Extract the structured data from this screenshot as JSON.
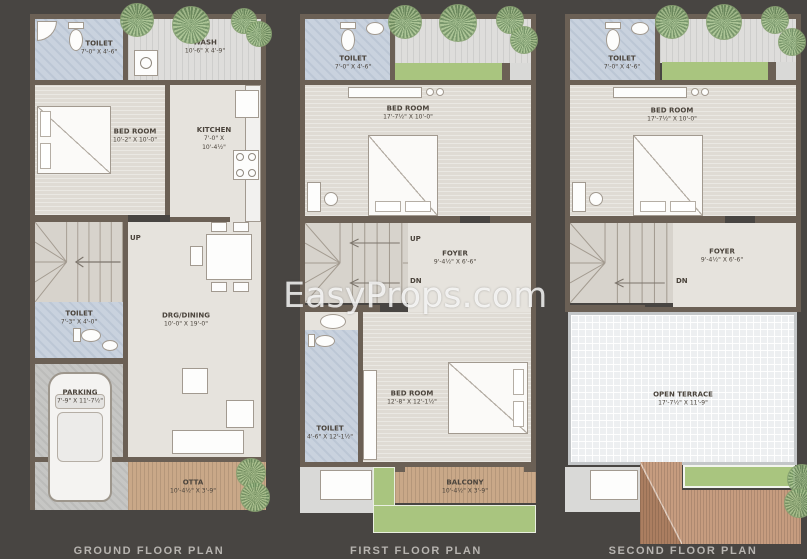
{
  "watermark": "EasyProps.com",
  "colors": {
    "background": "#484542",
    "wall": "#6b6055",
    "toilet_floor": "#c9d2de",
    "green_area": "#a9c57f",
    "roof_tan": "#c69c7f",
    "title_text": "#b7b4b0"
  },
  "plans": [
    {
      "title": "GROUND FLOOR PLAN",
      "stairs": {
        "up": "UP"
      },
      "rooms": {
        "toilet_top": {
          "name": "TOILET",
          "dims": "7'-0\" X 4'-6\""
        },
        "wash": {
          "name": "WASH",
          "dims": "10'-6\" X 4'-9\""
        },
        "bedroom": {
          "name": "BED ROOM",
          "dims": "10'-2\" X 10'-0\""
        },
        "kitchen": {
          "name": "KITCHEN",
          "dims": "7'-0\" X 10'-4½\""
        },
        "toilet_mid": {
          "name": "TOILET",
          "dims": "7'-3\" X 4'-0\""
        },
        "drg_dining": {
          "name": "DRG/DINING",
          "dims": "10'-0\" X 19'-0\""
        },
        "parking": {
          "name": "PARKING",
          "dims": "7'-9\" X 11'-7½\""
        },
        "otta": {
          "name": "OTTA",
          "dims": "10'-4½\" X 3'-9\""
        }
      }
    },
    {
      "title": "FIRST FLOOR PLAN",
      "stairs": {
        "up": "UP",
        "dn": "DN"
      },
      "rooms": {
        "toilet_top": {
          "name": "TOILET",
          "dims": "7'-0\" X 4'-6\""
        },
        "bedroom_top": {
          "name": "BED ROOM",
          "dims": "17'-7½\" X 10'-0\""
        },
        "foyer": {
          "name": "FOYER",
          "dims": "9'-4½\" X 6'-6\""
        },
        "bedroom_bottom": {
          "name": "BED ROOM",
          "dims": "12'-8\" X 12'-1½\""
        },
        "toilet_bottom": {
          "name": "TOILET",
          "dims": "4'-6\" X 12'-1½\""
        },
        "balcony": {
          "name": "BALCONY",
          "dims": "10'-4½\" X 3'-9\""
        }
      }
    },
    {
      "title": "SECOND FLOOR PLAN",
      "stairs": {
        "dn": "DN"
      },
      "rooms": {
        "toilet_top": {
          "name": "TOILET",
          "dims": "7'-0\" X 4'-6\""
        },
        "bedroom_top": {
          "name": "BED ROOM",
          "dims": "17'-7½\" X 10'-0\""
        },
        "foyer": {
          "name": "FOYER",
          "dims": "9'-4½\" X 6'-6\""
        },
        "open_terrace": {
          "name": "OPEN TERRACE",
          "dims": "17'-7½\" X 11'-9\""
        }
      }
    }
  ]
}
